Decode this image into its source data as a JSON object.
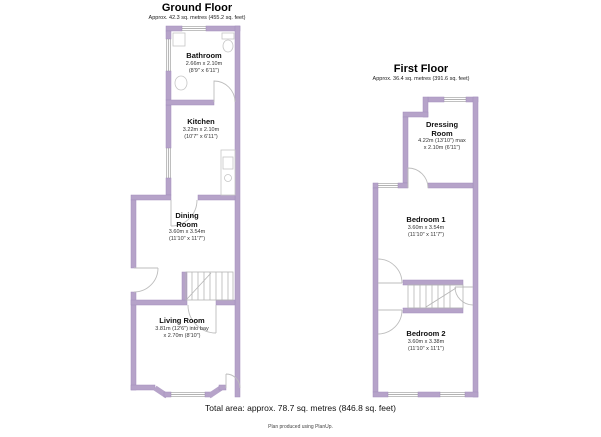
{
  "meta": {
    "total_area": "Total area: approx. 78.7 sq. metres (846.8 sq. feet)",
    "credit": "Plan produced using PlanUp.",
    "wall_color": "#b6a3c9"
  },
  "ground_floor": {
    "title": "Ground Floor",
    "subtitle": "Approx. 42.3 sq. metres (455.2 sq. feet)",
    "rooms": {
      "bathroom": {
        "name": "Bathroom",
        "dims1": "2.66m x 2.10m",
        "dims2": "(8'9\" x 6'11\")"
      },
      "kitchen": {
        "name": "Kitchen",
        "dims1": "3.22m x 2.10m",
        "dims2": "(10'7\" x 6'11\")"
      },
      "dining": {
        "name": "Dining Room",
        "dims1": "3.60m x 3.54m",
        "dims2": "(11'10\" x 11'7\")"
      },
      "living": {
        "name": "Living Room",
        "dims1": "3.81m (12'6\") into bay",
        "dims2": "x 2.70m (8'10\")"
      }
    }
  },
  "first_floor": {
    "title": "First Floor",
    "subtitle": "Approx. 36.4 sq. metres (391.6 sq. feet)",
    "rooms": {
      "dressing": {
        "name": "Dressing Room",
        "dims1": "4.22m (13'10\") max",
        "dims2": "x 2.10m (6'11\")"
      },
      "bedroom1": {
        "name": "Bedroom 1",
        "dims1": "3.60m x 3.54m",
        "dims2": "(11'10\" x 11'7\")"
      },
      "bedroom2": {
        "name": "Bedroom 2",
        "dims1": "3.60m x 3.38m",
        "dims2": "(11'10\" x 11'1\")"
      }
    }
  }
}
